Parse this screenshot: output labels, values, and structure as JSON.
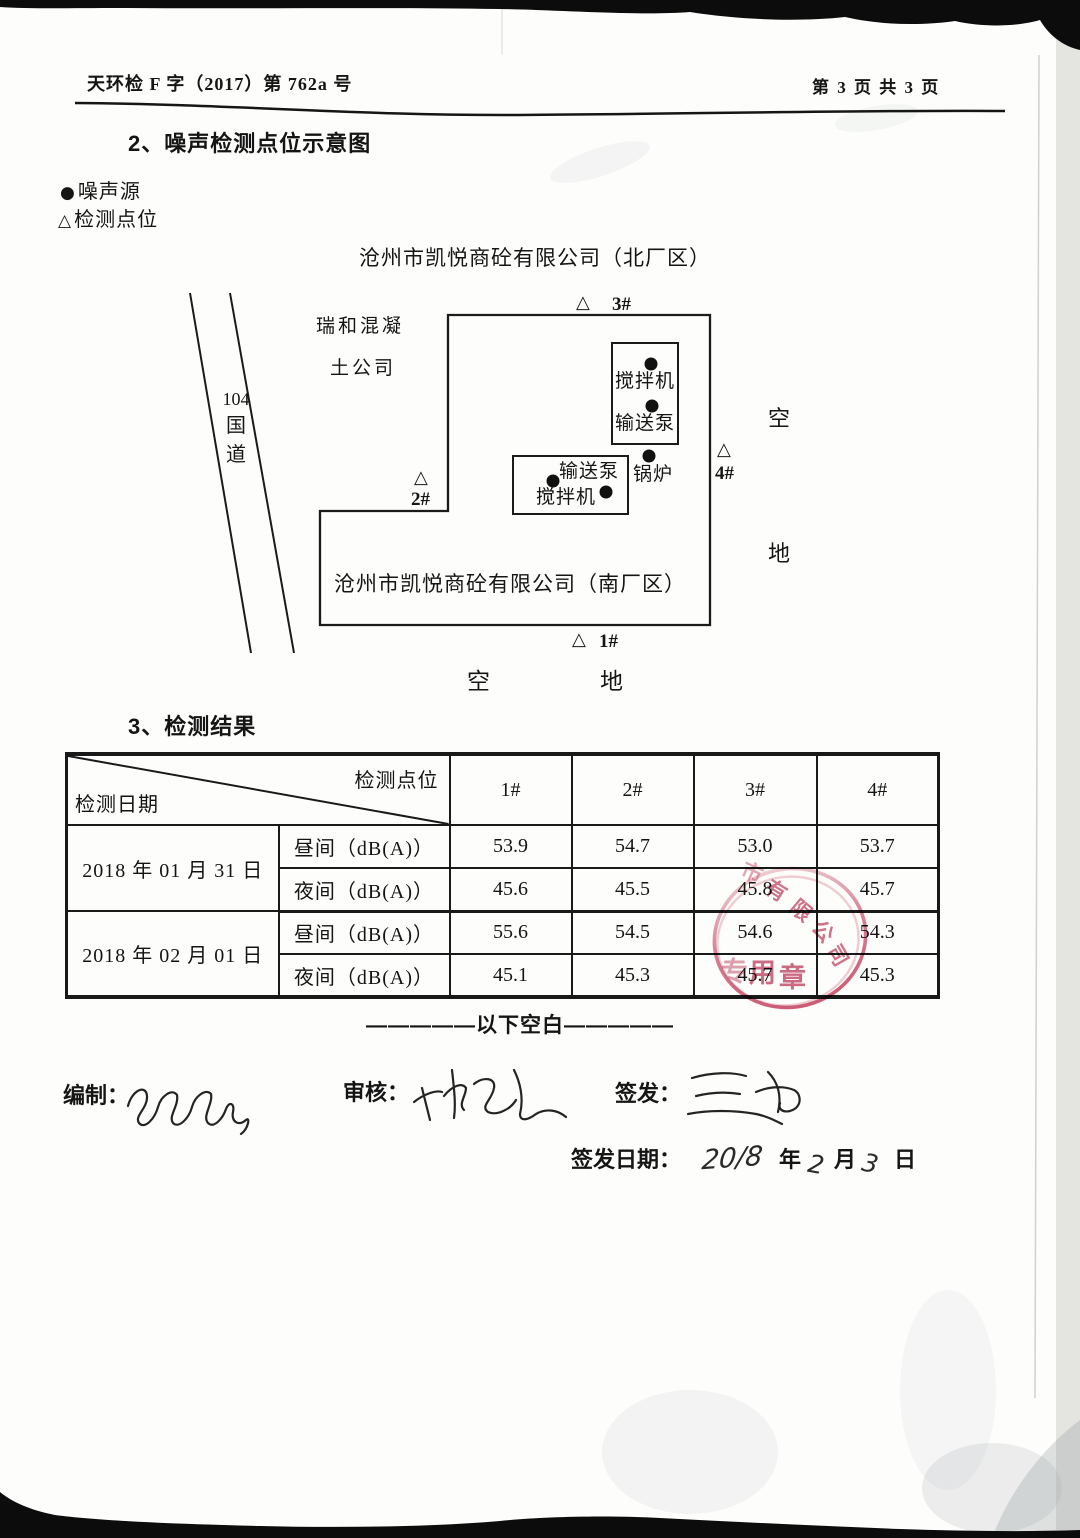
{
  "page": {
    "doc_number": "天环检 F 字（2017）第 762a 号",
    "page_indicator": "第 3 页 共 3 页"
  },
  "section2": {
    "title": "2、噪声检测点位示意图",
    "legend": [
      {
        "symbol": "●",
        "label": "噪声源"
      },
      {
        "symbol": "△",
        "label": "检测点位"
      }
    ]
  },
  "diagram": {
    "north_factory_title": "沧州市凯悦商砼有限公司（北厂区）",
    "south_factory_label": "沧州市凯悦商砼有限公司（南厂区）",
    "neighbor_company_line1": "瑞和混凝",
    "neighbor_company_line2": "土公司",
    "road_number": "104",
    "road_char1": "国",
    "road_char2": "道",
    "triangle_symbol": "△",
    "point1_label": "1#",
    "point2_label": "2#",
    "point3_label": "3#",
    "point4_label": "4#",
    "boxA_equipment1": "搅拌机",
    "boxA_equipment2": "输送泵",
    "boxB_equipment1": "输送泵",
    "boxB_equipment2": "搅拌机",
    "boiler_label": "锅炉",
    "open_right_char1": "空",
    "open_right_char2": "地",
    "open_bottom_char1": "空",
    "open_bottom_char2": "地"
  },
  "section3": {
    "title": "3、检测结果"
  },
  "results_table": {
    "corner_top": "检测点位",
    "corner_bottom": "检测日期",
    "point_headers": [
      "1#",
      "2#",
      "3#",
      "4#"
    ],
    "rows": [
      {
        "date": "2018 年 01 月 31 日",
        "periods": [
          {
            "label": "昼间（dB(A)）",
            "values": [
              "53.9",
              "54.7",
              "53.0",
              "53.7"
            ]
          },
          {
            "label": "夜间（dB(A)）",
            "values": [
              "45.6",
              "45.5",
              "45.8",
              "45.7"
            ]
          }
        ]
      },
      {
        "date": "2018 年 02 月 01 日",
        "periods": [
          {
            "label": "昼间（dB(A)）",
            "values": [
              "55.6",
              "54.5",
              "54.6",
              "54.3"
            ]
          },
          {
            "label": "夜间（dB(A)）",
            "values": [
              "45.1",
              "45.3",
              "45.7",
              "45.3"
            ]
          }
        ]
      }
    ]
  },
  "footer": {
    "blank_note": "—————以下空白—————",
    "prepared_label": "编制：",
    "reviewed_label": "审核：",
    "issued_label": "签发：",
    "issue_date_label": "签发日期：",
    "hw_year": "20/8",
    "year_char": "年",
    "hw_month": "2",
    "month_char": "月",
    "hw_day": "3",
    "day_char": "日"
  },
  "stamp": {
    "color": "#c94f6b",
    "arc_chars": [
      "市",
      "有",
      "限",
      "公",
      "司"
    ],
    "bottom_chars": [
      "专",
      "用",
      "章"
    ]
  }
}
